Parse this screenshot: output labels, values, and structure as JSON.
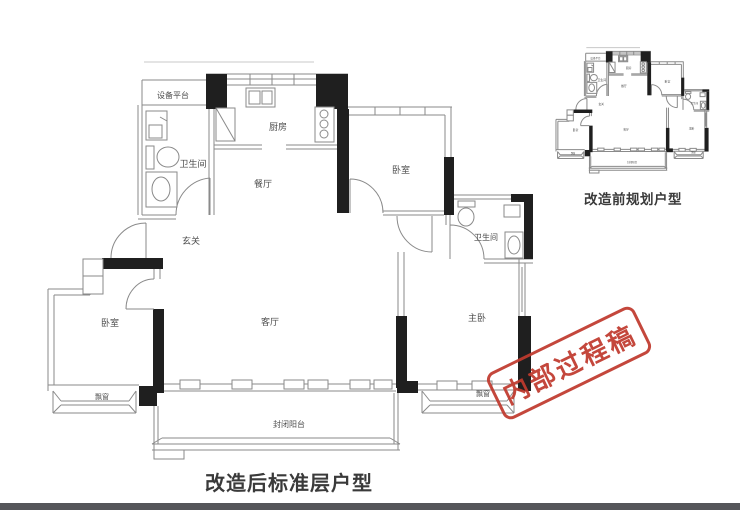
{
  "image": {
    "background": "#ffffff",
    "bottom_bar_color": "#55565a"
  },
  "plan_after": {
    "caption": "改造后标准层户型",
    "rooms": {
      "equipment_platform": "设备平台",
      "bathroom_left": "卫生间",
      "kitchen": "厨房",
      "dining_room": "餐厅",
      "bedroom_top": "卧室",
      "bathroom_right": "卫生间",
      "entry": "玄关",
      "living_room": "客厅",
      "bedroom_left": "卧室",
      "master_bedroom": "主卧",
      "bay_window_left": "飘窗",
      "bay_window_right": "飘窗",
      "balcony": "封闭阳台"
    }
  },
  "plan_before": {
    "caption": "改造前规划户型"
  },
  "stamp": {
    "text": "内部过程稿",
    "color": "#c03a2e"
  },
  "colors": {
    "wall": "#1f1f1f",
    "line": "#8a8a8a",
    "label": "#4c4c4c",
    "caption": "#3a3a3a"
  }
}
